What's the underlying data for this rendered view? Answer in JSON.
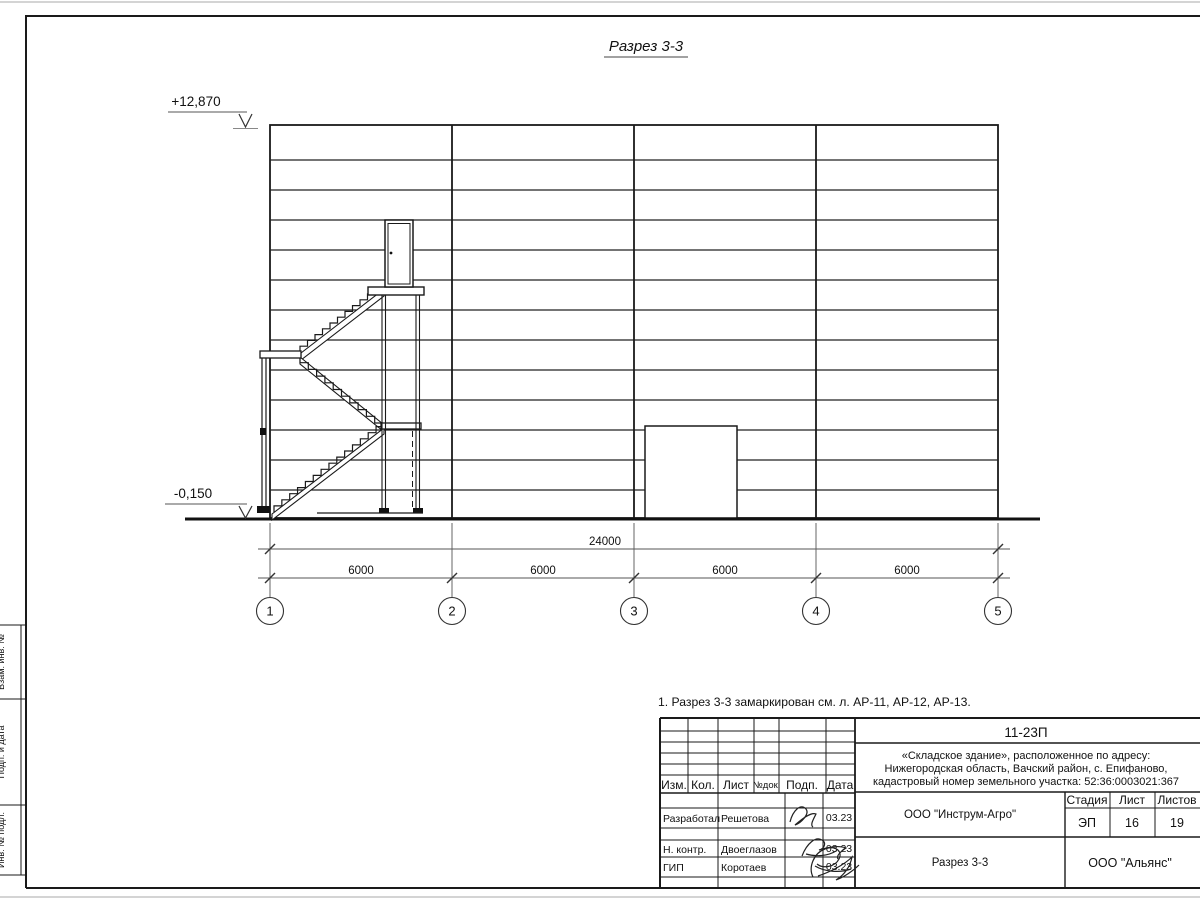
{
  "sheet": {
    "note": "1. Разрез 3-3 замаркирован см. л. АР-11, АР-12, АР-13.",
    "border_labels": {
      "vzam": "Взам. инв. №",
      "podp": "Подп. и дата",
      "inv": "Инв. № подл."
    },
    "colors": {
      "line": "#1a1a1a",
      "dim_line": "#555555",
      "edge": "#aaaaaa"
    }
  },
  "drawing": {
    "title": "Разрез 3-3",
    "levels": {
      "top": "+12,870",
      "ground": "-0,150"
    },
    "dimensions": {
      "total": "24000",
      "span1": "6000",
      "span2": "6000",
      "span3": "6000",
      "span4": "6000"
    },
    "axes": {
      "a1": "1",
      "a2": "2",
      "a3": "3",
      "a4": "4",
      "a5": "5"
    }
  },
  "title_block": {
    "doc_number": "11-23П",
    "project_line1": "«Складское здание», расположенное по адресу:",
    "project_line2": "Нижегородская область, Вачский район, с. Епифаново,",
    "project_line3": "кадастровый номер земельного участка: 52:36:0003021:367",
    "cols": {
      "izm": "Изм.",
      "kol": "Кол.",
      "list": "Лист",
      "ndok": "№док.",
      "podp": "Подп.",
      "data": "Дата"
    },
    "row1": {
      "role": "Разработал",
      "name": "Решетова",
      "date": "03.23"
    },
    "row2": {
      "role": "Н. контр.",
      "name": "Двоеглазов",
      "date": "03.23"
    },
    "row3": {
      "role": "ГИП",
      "name": "Коротаев",
      "date": "03.23"
    },
    "org1": "ООО \"Инструм-Агро\"",
    "stage_label": "Стадия",
    "sheet_label": "Лист",
    "sheets_label": "Листов",
    "stage": "ЭП",
    "sheet_no": "16",
    "sheets_total": "19",
    "drawing_name": "Разрез 3-3",
    "org2": "ООО \"Альянс\""
  }
}
